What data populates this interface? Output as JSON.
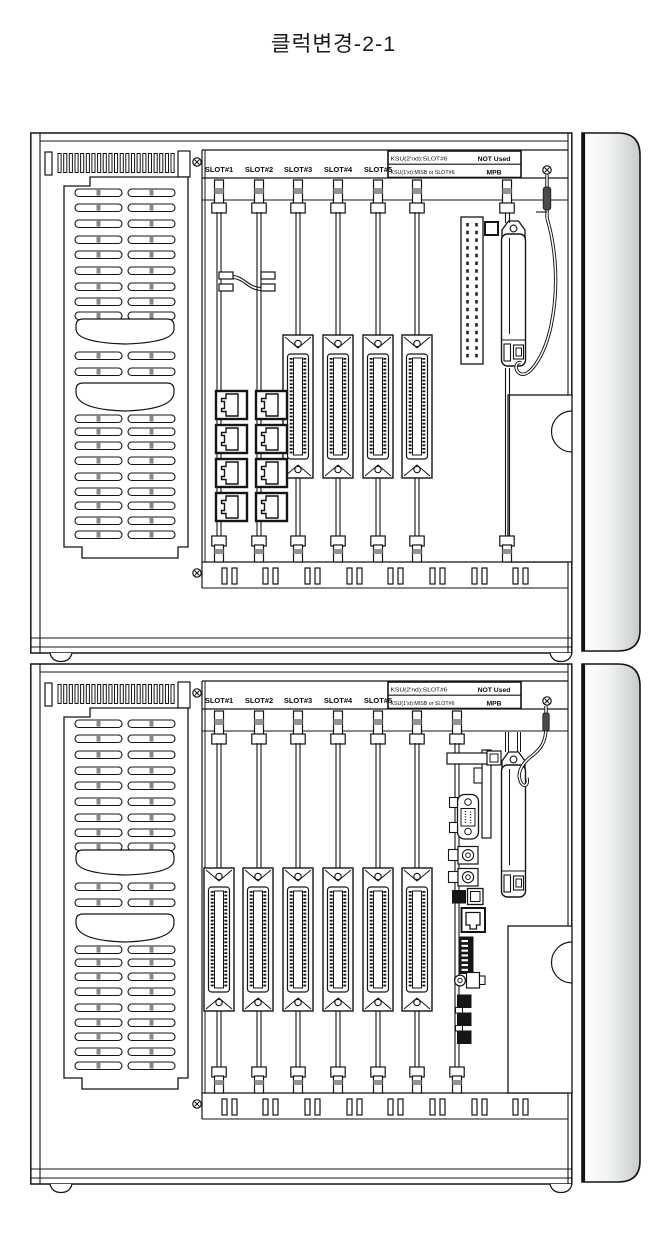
{
  "title": "클럭변경-2-1",
  "cabinets": [
    {
      "name": "KSU upper cabinet",
      "slot_labels": [
        "SLOT#1",
        "SLOT#2",
        "SLOT#3",
        "SLOT#4",
        "SLOT#5"
      ],
      "slot6_box": {
        "line1_left": "KSU(2'nd):SLOT#6",
        "line1_right": "NOT Used",
        "line2_left": "KSU(1'st):MISB or SLOT#6",
        "line2_right": "MPB"
      }
    },
    {
      "name": "KSU lower cabinet",
      "slot_labels": [
        "SLOT#1",
        "SLOT#2",
        "SLOT#3",
        "SLOT#4",
        "SLOT#5"
      ],
      "slot6_box": {
        "line1_left": "KSU(2'nd):SLOT#6",
        "line1_right": "NOT Used",
        "line2_left": "KSU(1'st):MISB or SLOT#6",
        "line2_right": "MPB"
      }
    }
  ],
  "colors": {
    "line": "#141414",
    "side_panel_gray": "#cfd3d3",
    "latch_gray": "#949494",
    "dark_fill": "#161616"
  }
}
